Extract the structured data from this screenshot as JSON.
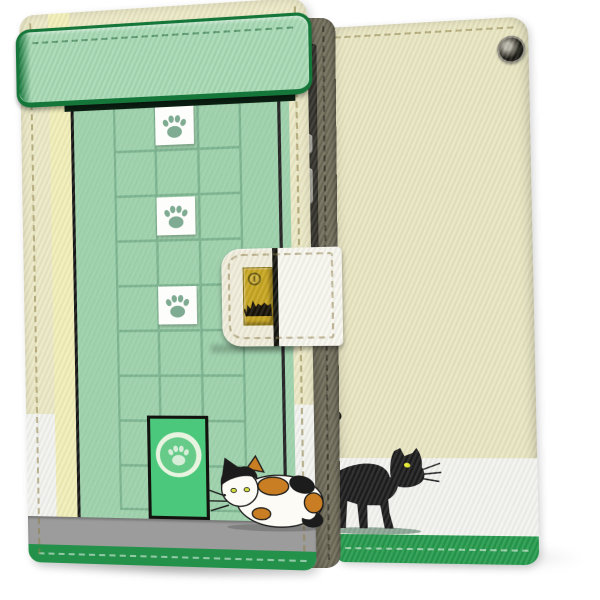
{
  "product": {
    "kind": "wallet flip smartphone case, cat theme, product photo on white background",
    "views": {
      "front": {
        "elements": [
          "rounded green top flap with stitching",
          "mint wall with tile grid",
          "three white paw-print tiles",
          "green cat door with paw medallion",
          "calico cat crouching by door",
          "gray walkway stripe",
          "green stitched hem",
          "cream snap strap with gold buckle",
          "scratched cat etching on buckle",
          "round snap lock"
        ]
      },
      "back": {
        "elements": [
          "cream cover with stitching",
          "camera opening top right",
          "black cat walking",
          "white stripe",
          "green stitched hem",
          "strap hole on spine edge"
        ]
      },
      "spine": {
        "elements": [
          "olive stitched spine",
          "phone side edge with metal buttons"
        ]
      }
    }
  },
  "icons": [
    "paw-print-icon",
    "camera-hole-icon",
    "snap-button-icon",
    "cat-etching-icon"
  ],
  "colors": {
    "page_bg": "#ffffff",
    "front_edge_cream": "#ece9c6",
    "front_inner_yellow": "#f2efb9",
    "flap_green": "#a6d9b3",
    "flap_border_green": "#15763a",
    "panel_green": "#9cd5ab",
    "grid_line_green": "#72b088",
    "tile_white": "#fdfdfb",
    "paw_green": "#7fab92",
    "panel_outline_black": "#141414",
    "door_green": "#4cc87c",
    "door_ring": "#e8f4e0",
    "door_disc": "#66cb88",
    "door_paw": "#d6eed8",
    "walk_gray": "#9c9c9c",
    "hem_green": "#23914a",
    "clasp_cream": "#f0eddb",
    "clasp_white": "#f8f7ef",
    "buckle_gold": "#c7a51f",
    "buckle_border": "#8a7312",
    "snap_outline": "#6b5a0e",
    "back_cream": "#e9e6c2",
    "back_white": "#f3f4f0",
    "back_hem_green": "#24994b",
    "spine_olive": "#6f6b58",
    "spine_phone_dark": "#3a3830",
    "button_metal": "#b7b5ac",
    "cat_black": "#1c1c1c",
    "cat_eye_yellow": "#e6ea2d",
    "calico_white": "#fcfbf6",
    "calico_orange": "#c97e23",
    "calico_eye": "#d8e23f"
  }
}
